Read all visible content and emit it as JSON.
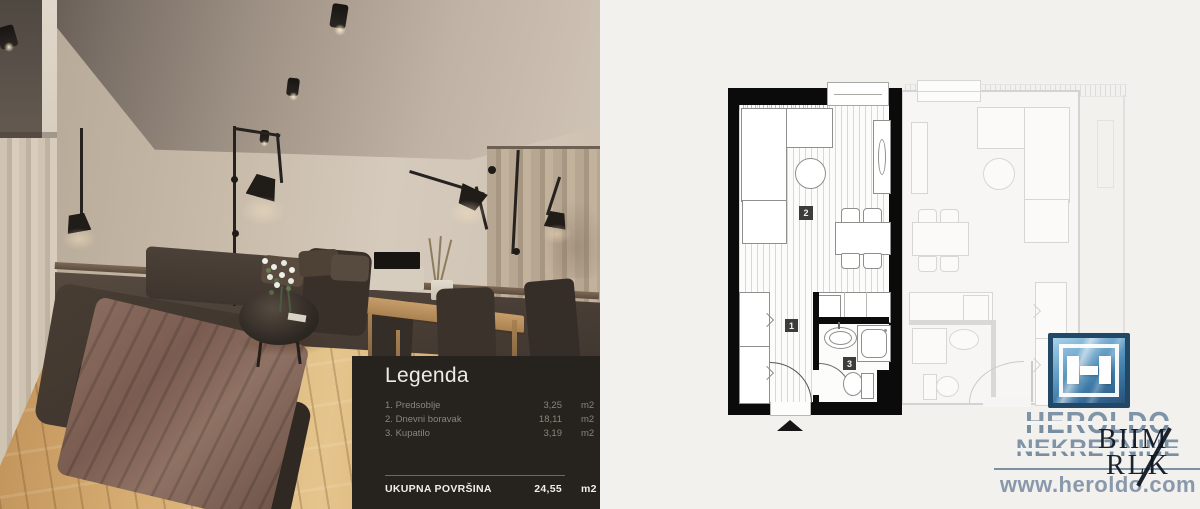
{
  "legend": {
    "title": "Legenda",
    "items": [
      {
        "num": "1.",
        "name": "Predsoblje",
        "area": "3,25",
        "unit": "m2"
      },
      {
        "num": "2.",
        "name": "Dnevni boravak",
        "area": "18,11",
        "unit": "m2"
      },
      {
        "num": "3.",
        "name": "Kupatilo",
        "area": "3,19",
        "unit": "m2"
      }
    ],
    "total_label": "UKUPNA POVRŠINA",
    "total_value": "24,55",
    "total_unit": "m2"
  },
  "floorplan": {
    "markers": [
      "1",
      "2",
      "3"
    ]
  },
  "branding": {
    "company_line1": "HEROLDO",
    "company_line2": "NEKRETNINE",
    "website": "www.heroldo.com",
    "watermark_line1": "BIIM",
    "watermark_line2": "RLK",
    "colors": {
      "logo_blue": "#2e6b9e",
      "logo_text": "#8094a8",
      "website_text": "#8999ab",
      "legend_background": "#26221e",
      "plan_wall_black": "#0b0b0b",
      "ghost_line_gray": "#d3d3d1",
      "floor_wood": "#d6ad72"
    }
  }
}
